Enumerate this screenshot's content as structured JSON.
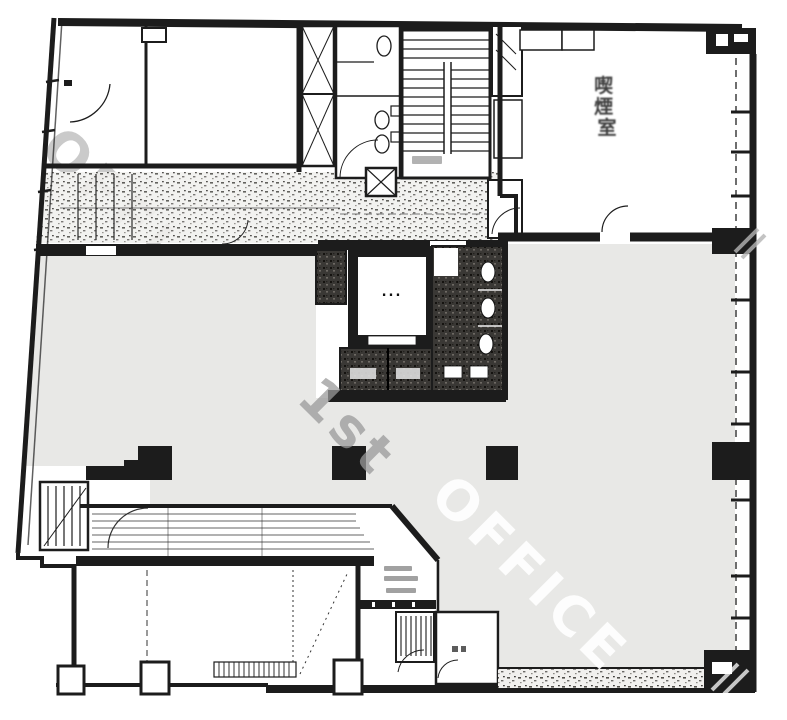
{
  "meta": {
    "type": "architectural-floor-plan-scan"
  },
  "watermark": {
    "word1": "OFFICE",
    "word2": "1st",
    "word3": "OFFICE"
  },
  "rooms": {
    "smoking_room_label": "喫煙室",
    "smoking_room_chars": [
      "喫",
      "煙",
      "室"
    ]
  },
  "elevator": {
    "dots": "..."
  },
  "colors": {
    "floor_fill": "#e8e8e6",
    "ink": "#1c1c1c",
    "watermark_gray": "#a8a8a8",
    "watermark_white": "#ffffff"
  }
}
